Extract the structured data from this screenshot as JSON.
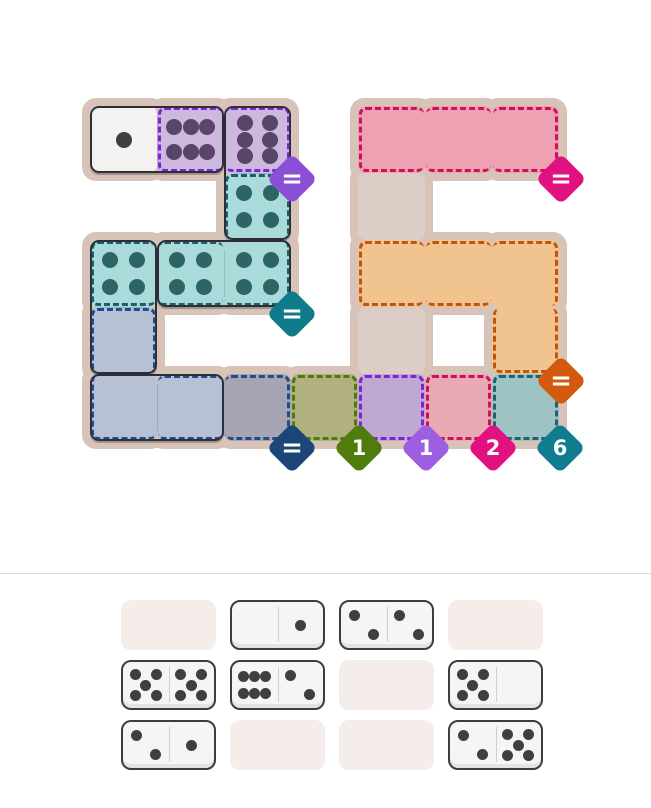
{
  "canvas": {
    "width": 651,
    "height": 808,
    "background": "#ffffff"
  },
  "divider": {
    "y": 573,
    "color": "#dcdcdc"
  },
  "pip_layouts": {
    "0": [],
    "1": [
      [
        50,
        50
      ]
    ],
    "2": [
      [
        29,
        29
      ],
      [
        71,
        71
      ]
    ],
    "4": [
      [
        30,
        30
      ],
      [
        70,
        30
      ],
      [
        30,
        70
      ],
      [
        70,
        70
      ]
    ],
    "5": [
      [
        27,
        27
      ],
      [
        73,
        27
      ],
      [
        50,
        50
      ],
      [
        27,
        73
      ],
      [
        73,
        73
      ]
    ],
    "6h": [
      [
        26,
        31
      ],
      [
        50,
        31
      ],
      [
        74,
        31
      ],
      [
        26,
        69
      ],
      [
        50,
        69
      ],
      [
        74,
        69
      ]
    ],
    "6v": [
      [
        31,
        26
      ],
      [
        31,
        50
      ],
      [
        31,
        74
      ],
      [
        69,
        26
      ],
      [
        69,
        50
      ],
      [
        69,
        74
      ]
    ]
  },
  "board": {
    "origin": {
      "x": 90,
      "y": 106
    },
    "cell_size": 67,
    "backing_color": "#d8c3b8",
    "backing_pad": 8,
    "dot_size": 16,
    "outline_color": "#2e2e38",
    "cells": [
      {
        "row": 0,
        "col": 0,
        "fill": "#f3f2f1",
        "pips": "1",
        "dot": "#3f3f3f",
        "dash": null,
        "edges": ""
      },
      {
        "row": 0,
        "col": 1,
        "fill": "#ccb9dd",
        "pips": "6h",
        "dot": "#584569",
        "dash": "#7e22dd",
        "edges": "tlb"
      },
      {
        "row": 0,
        "col": 2,
        "fill": "#ccb9dd",
        "pips": "6v",
        "dot": "#584569",
        "dash": "#7e22dd",
        "edges": "trb"
      },
      {
        "row": 0,
        "col": 4,
        "fill": "#eea1b2",
        "pips": null,
        "dot": null,
        "dash": "#cb1457",
        "edges": "tlb"
      },
      {
        "row": 0,
        "col": 5,
        "fill": "#eea1b2",
        "pips": null,
        "dot": null,
        "dash": "#cb1457",
        "edges": "tb"
      },
      {
        "row": 0,
        "col": 6,
        "fill": "#eea1b2",
        "pips": null,
        "dot": null,
        "dash": "#cb1457",
        "edges": "trb"
      },
      {
        "row": 1,
        "col": 2,
        "fill": "#aadbda",
        "pips": "4",
        "dot": "#2d6464",
        "dash": "#19606c",
        "edges": "tlr"
      },
      {
        "row": 1,
        "col": 4,
        "fill": "#dccdc6",
        "pips": null,
        "dot": null,
        "dash": null,
        "edges": ""
      },
      {
        "row": 2,
        "col": 0,
        "fill": "#aadbda",
        "pips": "4",
        "dot": "#2d6464",
        "dash": "#19606c",
        "edges": "tlb"
      },
      {
        "row": 2,
        "col": 1,
        "fill": "#aadbda",
        "pips": "4",
        "dot": "#2d6464",
        "dash": "#19606c",
        "edges": "tb"
      },
      {
        "row": 2,
        "col": 2,
        "fill": "#aadbda",
        "pips": "4",
        "dot": "#2d6464",
        "dash": "#19606c",
        "edges": "rb"
      },
      {
        "row": 2,
        "col": 4,
        "fill": "#f1c38f",
        "pips": null,
        "dot": null,
        "dash": "#c05510",
        "edges": "tlb"
      },
      {
        "row": 2,
        "col": 5,
        "fill": "#f1c38f",
        "pips": null,
        "dot": null,
        "dash": "#c05510",
        "edges": "tb"
      },
      {
        "row": 2,
        "col": 6,
        "fill": "#f1c38f",
        "pips": null,
        "dot": null,
        "dash": "#c05510",
        "edges": "tr"
      },
      {
        "row": 3,
        "col": 0,
        "fill": "#b7c1d5",
        "pips": "0",
        "dot": null,
        "dash": "#1d4d8b",
        "edges": "tlr"
      },
      {
        "row": 3,
        "col": 4,
        "fill": "#dccdc6",
        "pips": null,
        "dot": null,
        "dash": null,
        "edges": ""
      },
      {
        "row": 3,
        "col": 6,
        "fill": "#f1c38f",
        "pips": null,
        "dot": null,
        "dash": "#c05510",
        "edges": "lrb"
      },
      {
        "row": 4,
        "col": 0,
        "fill": "#b7c1d5",
        "pips": "0",
        "dot": null,
        "dash": "#1d4d8b",
        "edges": "lb"
      },
      {
        "row": 4,
        "col": 1,
        "fill": "#b7c1d5",
        "pips": "0",
        "dot": null,
        "dash": "#1d4d8b",
        "edges": "tb"
      },
      {
        "row": 4,
        "col": 2,
        "fill": "#a7a5b4",
        "pips": null,
        "dot": null,
        "dash": "#1d4d8b",
        "edges": "tbr"
      },
      {
        "row": 4,
        "col": 3,
        "fill": "#b1b080",
        "pips": null,
        "dot": null,
        "dash": "#4f7a10",
        "edges": "tlrb"
      },
      {
        "row": 4,
        "col": 4,
        "fill": "#c0a9d1",
        "pips": null,
        "dot": null,
        "dash": "#7e22dd",
        "edges": "tlrb"
      },
      {
        "row": 4,
        "col": 5,
        "fill": "#e9a9b4",
        "pips": null,
        "dot": null,
        "dash": "#cb1457",
        "edges": "tlrb"
      },
      {
        "row": 4,
        "col": 6,
        "fill": "#9fc2c4",
        "pips": null,
        "dot": null,
        "dash": "#1b6470",
        "edges": "tlrb"
      }
    ],
    "dominoes": [
      {
        "name": "placed-domino-1-6",
        "cells": [
          [
            0,
            0
          ],
          [
            0,
            1
          ]
        ]
      },
      {
        "name": "placed-domino-6-4",
        "cells": [
          [
            0,
            2
          ],
          [
            1,
            2
          ]
        ]
      },
      {
        "name": "placed-domino-4-4",
        "cells": [
          [
            2,
            1
          ],
          [
            2,
            2
          ]
        ]
      },
      {
        "name": "placed-domino-4-0",
        "cells": [
          [
            2,
            0
          ],
          [
            3,
            0
          ]
        ]
      },
      {
        "name": "placed-domino-0-0",
        "cells": [
          [
            4,
            0
          ],
          [
            4,
            1
          ]
        ]
      }
    ],
    "badges": [
      {
        "name": "purple-equals",
        "label": "=",
        "color": "#8b4ed6",
        "cx": 292,
        "cy": 179
      },
      {
        "name": "pink-equals",
        "label": "=",
        "color": "#e01180",
        "cx": 561,
        "cy": 179
      },
      {
        "name": "teal-equals",
        "label": "=",
        "color": "#0f7b8a",
        "cx": 292,
        "cy": 314
      },
      {
        "name": "orange-equals",
        "label": "=",
        "color": "#d2590e",
        "cx": 561,
        "cy": 381
      },
      {
        "name": "navy-equals",
        "label": "=",
        "color": "#1d4678",
        "cx": 292,
        "cy": 448
      },
      {
        "name": "olive-one",
        "label": "1",
        "color": "#507c0e",
        "cx": 359,
        "cy": 448
      },
      {
        "name": "purple-one",
        "label": "1",
        "color": "#9e5ee2",
        "cx": 426,
        "cy": 448
      },
      {
        "name": "pink-two",
        "label": "2",
        "color": "#e21180",
        "cx": 493,
        "cy": 448
      },
      {
        "name": "teal-six",
        "label": "6",
        "color": "#117b90",
        "cx": 560,
        "cy": 448
      }
    ]
  },
  "tray": {
    "origin": {
      "x": 121,
      "y": 600
    },
    "slot_w": 95,
    "slot_h": 50,
    "gap_x": 14,
    "gap_y": 10,
    "empty_fill": "#f5ede9",
    "tile_fill": "#f6f5f4",
    "tile_border": "#3d3d3d",
    "dot_color": "#3f3f3f",
    "dot_size": 11,
    "slots": [
      {
        "row": 0,
        "col": 0,
        "type": "empty"
      },
      {
        "row": 0,
        "col": 1,
        "type": "domino",
        "left": 0,
        "right": 1
      },
      {
        "row": 0,
        "col": 2,
        "type": "domino",
        "left": 2,
        "right": 2
      },
      {
        "row": 0,
        "col": 3,
        "type": "empty"
      },
      {
        "row": 1,
        "col": 0,
        "type": "domino",
        "left": 5,
        "right": 5
      },
      {
        "row": 1,
        "col": 1,
        "type": "domino",
        "left": 6,
        "right": 2
      },
      {
        "row": 1,
        "col": 2,
        "type": "empty"
      },
      {
        "row": 1,
        "col": 3,
        "type": "domino",
        "left": 5,
        "right": 0
      },
      {
        "row": 2,
        "col": 0,
        "type": "domino",
        "left": 2,
        "right": 1
      },
      {
        "row": 2,
        "col": 1,
        "type": "empty"
      },
      {
        "row": 2,
        "col": 2,
        "type": "empty"
      },
      {
        "row": 2,
        "col": 3,
        "type": "domino",
        "left": 2,
        "right": 5
      }
    ]
  }
}
